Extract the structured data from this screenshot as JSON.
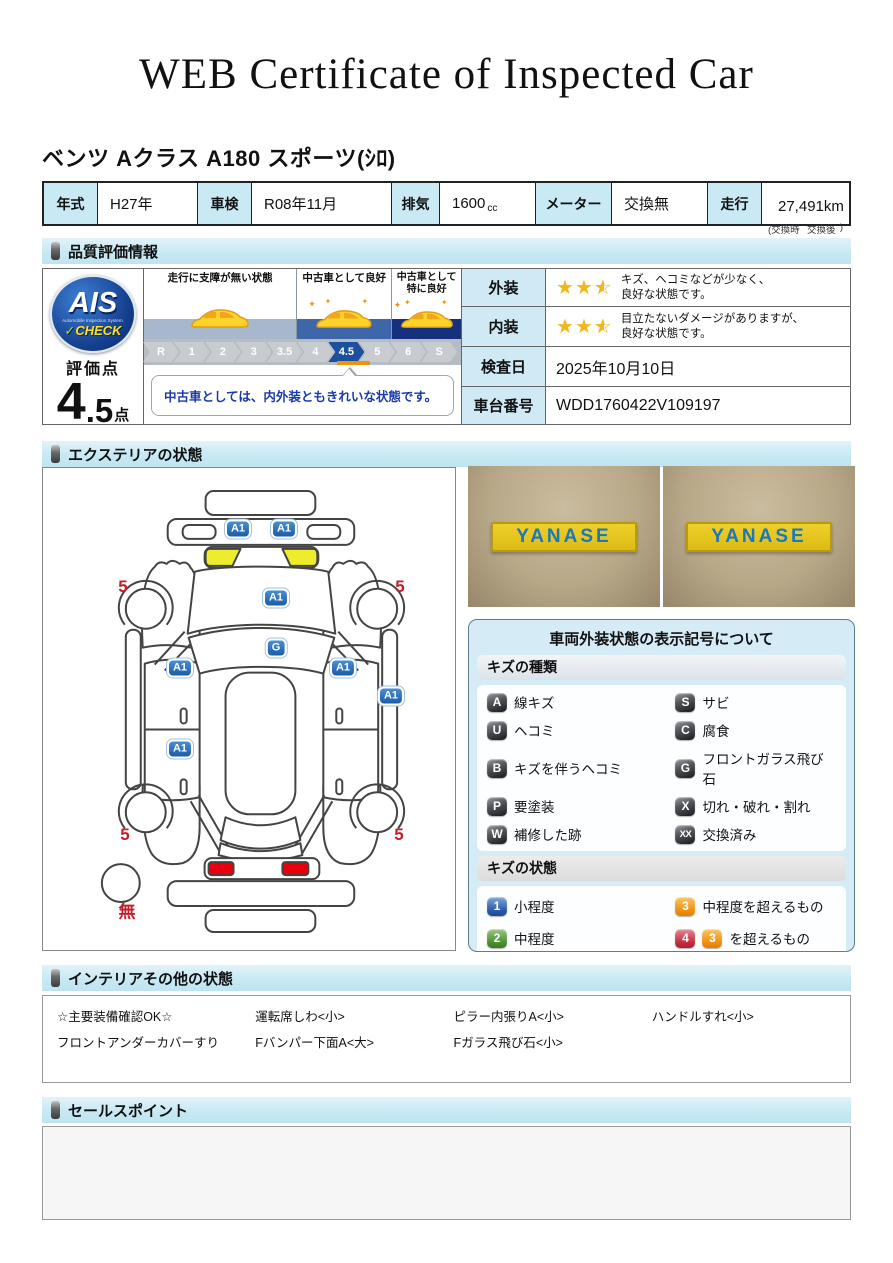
{
  "title": "WEB Certificate of Inspected Car",
  "car_name": "ベンツ Aクラス A180 スポーツ(ｼﾛ)",
  "spec_table": {
    "year_label": "年式",
    "year": "H27年",
    "inspection_label": "車検",
    "inspection": "R08年11月",
    "displacement_label": "排気",
    "displacement": "1600",
    "displacement_unit": "cc",
    "meter_label": "メーター",
    "meter": "交換無",
    "mileage_label": "走行",
    "mileage": "27,491km",
    "mileage_note_open": "(交換時",
    "mileage_note_mid": "交換後",
    "mileage_note_close": ")"
  },
  "sections": {
    "quality": "品質評価情報",
    "exterior": "エクステリアの状態",
    "interior": "インテリアその他の状態",
    "sales": "セールスポイント"
  },
  "quality": {
    "ais": {
      "logo": "AIS",
      "logo_sub": "Automobile Inspection System.",
      "logo_check": "CHECK",
      "check_mark": "✓"
    },
    "score_label": "評価点",
    "score_int": "4",
    "score_dec": ".5",
    "score_unit": "点",
    "scale": {
      "zones": [
        {
          "label": "走行に支障が無い状態"
        },
        {
          "label": "中古車として良好"
        },
        {
          "label": "中古車として\n特に良好"
        }
      ],
      "steps": [
        "R",
        "1",
        "2",
        "3",
        "3.5",
        "4",
        "4.5",
        "5",
        "6",
        "S"
      ],
      "active": "4.5",
      "comment": "中古車としては、内外装ともきれいな状態です。"
    },
    "rows": [
      {
        "label": "外装",
        "stars": 2.5,
        "text": "キズ、ヘコミなどが少なく、\n良好な状態です。"
      },
      {
        "label": "内装",
        "stars": 2.5,
        "text": "目立たないダメージがありますが、\n良好な状態です。"
      },
      {
        "label": "検査日",
        "value": "2025年10月10日"
      },
      {
        "label": "車台番号",
        "value": "WDD1760422V109197"
      }
    ]
  },
  "exterior": {
    "photo_sign": "YANASE",
    "markers": [
      {
        "code": "A1",
        "x": 195,
        "y": 61
      },
      {
        "code": "A1",
        "x": 241,
        "y": 61
      },
      {
        "code": "A1",
        "x": 233,
        "y": 130
      },
      {
        "code": "G",
        "x": 233,
        "y": 180
      },
      {
        "code": "A1",
        "x": 137,
        "y": 200
      },
      {
        "code": "A1",
        "x": 300,
        "y": 200
      },
      {
        "code": "A1",
        "x": 348,
        "y": 228
      },
      {
        "code": "A1",
        "x": 137,
        "y": 281
      },
      {
        "code": "5",
        "x": 80,
        "y": 119,
        "red": true
      },
      {
        "code": "5",
        "x": 357,
        "y": 119,
        "red": true
      },
      {
        "code": "5",
        "x": 82,
        "y": 367,
        "red": true
      },
      {
        "code": "5",
        "x": 356,
        "y": 367,
        "red": true
      },
      {
        "code": "無",
        "x": 84,
        "y": 442,
        "red": true
      }
    ],
    "legend": {
      "title": "車両外装状態の表示記号について",
      "kind_header": "キズの種類",
      "kinds": [
        {
          "code": "A",
          "label": "線キズ"
        },
        {
          "code": "S",
          "label": "サビ"
        },
        {
          "code": "U",
          "label": "ヘコミ"
        },
        {
          "code": "C",
          "label": "腐食"
        },
        {
          "code": "B",
          "label": "キズを伴うヘコミ"
        },
        {
          "code": "G",
          "label": "フロントガラス飛び石"
        },
        {
          "code": "P",
          "label": "要塗装"
        },
        {
          "code": "X",
          "label": "切れ・破れ・割れ"
        },
        {
          "code": "W",
          "label": "補修した跡"
        },
        {
          "code": "XX",
          "label": "交換済み"
        }
      ],
      "state_header": "キズの状態",
      "states": [
        {
          "code": "1",
          "color": "blue",
          "label": "小程度"
        },
        {
          "code": "3",
          "color": "orange",
          "label": "中程度を超えるもの"
        },
        {
          "code": "2",
          "color": "green",
          "label": "中程度"
        },
        {
          "code": "4",
          "color": "red",
          "extra_code": "3",
          "extra_color": "orange",
          "label": "を超えるもの"
        }
      ]
    }
  },
  "interior_notes": [
    [
      "☆主要装備確認OK☆",
      "運転席しわ<小>",
      "ピラー内張りA<小>",
      "ハンドルすれ<小>"
    ],
    [
      "フロントアンダーカバーすり",
      "Fバンパー下面A<大>",
      "Fガラス飛び石<小>",
      ""
    ]
  ],
  "colors": {
    "accent_blue": "#1d4f9f",
    "badge_blue": "#2a6cb8",
    "marker_red": "#c0202c",
    "star_gold": "#f3b71e",
    "header_blue": "#c9e9f4",
    "sign_yellow": "#e9c91f",
    "sign_blue": "#1b78ba",
    "zone_band_1": "#a8b8cc",
    "zone_band_2": "#3f66a8",
    "zone_band_3": "#16307e",
    "taillight_red": "#e8000d",
    "headlight_yellow": "#eded2d",
    "indicator_orange": "#ef940a"
  }
}
